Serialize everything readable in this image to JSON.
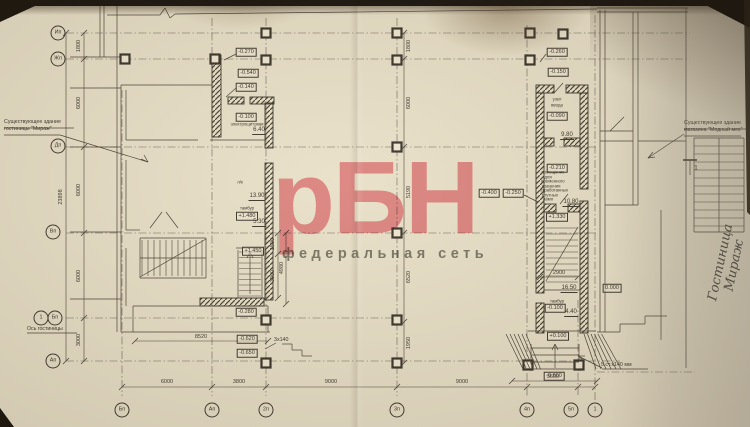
{
  "watermark": {
    "text": "рБН",
    "subtext": "федеральная сеть",
    "color": "#f195a2",
    "subcolor": "#85857e"
  },
  "notes": {
    "left_building": [
      "Существующее здание",
      "гостиницы \"Мираж\""
    ],
    "right_building": [
      "Существующее здание",
      "магазина \"Модный мех\""
    ],
    "hotel_axis": "Ось гостиницы",
    "handwriting": [
      "Гостиница",
      "Мираж"
    ],
    "section_label": "1",
    "steps_note": "5 ст.х140 мм",
    "steps_note_small": "3х140"
  },
  "axis_bubbles": [
    {
      "label": "Ип",
      "x": 58,
      "y": 33
    },
    {
      "label": "Жп",
      "x": 58,
      "y": 59
    },
    {
      "label": "Дп",
      "x": 58,
      "y": 146
    },
    {
      "label": "Вп",
      "x": 53,
      "y": 232
    },
    {
      "label": "1",
      "x": 41,
      "y": 318
    },
    {
      "label": "Бп",
      "x": 55,
      "y": 318
    },
    {
      "label": "Ап",
      "x": 53,
      "y": 361
    },
    {
      "label": "Бп",
      "x": 122,
      "y": 410
    },
    {
      "label": "Ап",
      "x": 212,
      "y": 410
    },
    {
      "label": "2п",
      "x": 266,
      "y": 410
    },
    {
      "label": "3п",
      "x": 397,
      "y": 410
    },
    {
      "label": "4п",
      "x": 527,
      "y": 410
    },
    {
      "label": "5п",
      "x": 571,
      "y": 410
    },
    {
      "label": "1",
      "x": 595,
      "y": 410
    }
  ],
  "elevations": [
    {
      "text": "-0.270",
      "x": 246,
      "y": 52
    },
    {
      "text": "-0.540",
      "x": 248,
      "y": 73
    },
    {
      "text": "-0.140",
      "x": 246,
      "y": 87
    },
    {
      "text": "-0.100",
      "x": 246,
      "y": 117
    },
    {
      "text": "+1.480",
      "x": 247,
      "y": 216
    },
    {
      "text": "+1.450",
      "x": 253,
      "y": 251
    },
    {
      "text": "-0.280",
      "x": 246,
      "y": 312
    },
    {
      "text": "-0.620",
      "x": 247,
      "y": 339
    },
    {
      "text": "-0.650",
      "x": 247,
      "y": 353
    },
    {
      "text": "-0.400",
      "x": 489,
      "y": 193
    },
    {
      "text": "-0.250",
      "x": 513,
      "y": 193
    },
    {
      "text": "-0.260",
      "x": 557,
      "y": 52
    },
    {
      "text": "-0.150",
      "x": 558,
      "y": 72
    },
    {
      "text": "-0.090",
      "x": 557,
      "y": 116
    },
    {
      "text": "-0.210",
      "x": 557,
      "y": 168
    },
    {
      "text": "+1.330",
      "x": 557,
      "y": 217
    },
    {
      "text": "-0.100",
      "x": 555,
      "y": 308
    },
    {
      "text": "+0.100",
      "x": 558,
      "y": 336
    },
    {
      "text": "-0.600",
      "x": 554,
      "y": 376
    },
    {
      "text": "0.000",
      "x": 612,
      "y": 288
    }
  ],
  "areas": [
    {
      "text": "6.40",
      "x": 259,
      "y": 131
    },
    {
      "text": "13.90",
      "x": 257,
      "y": 197
    },
    {
      "text": "5.30",
      "x": 259,
      "y": 223
    },
    {
      "text": "9.80",
      "x": 567,
      "y": 136
    },
    {
      "text": "10.80",
      "x": 571,
      "y": 203
    },
    {
      "text": "16.50",
      "x": 569,
      "y": 289
    },
    {
      "text": "4.40",
      "x": 571,
      "y": 313
    }
  ],
  "room_labels": [
    {
      "text": "электрощитовая",
      "x": 247,
      "y": 125
    },
    {
      "text": "л/к",
      "x": 240,
      "y": 183
    },
    {
      "text": "тамбур",
      "x": 247,
      "y": 209
    },
    {
      "text": "узел",
      "x": 557,
      "y": 100
    },
    {
      "text": "ввода",
      "x": 557,
      "y": 106
    },
    {
      "text": "помещение",
      "x": 553,
      "y": 173
    },
    {
      "text": "для",
      "x": 548,
      "y": 177.5
    },
    {
      "text": "временного",
      "x": 553,
      "y": 182
    },
    {
      "text": "хранения",
      "x": 551,
      "y": 186.5
    },
    {
      "text": "отработанных",
      "x": 554,
      "y": 191
    },
    {
      "text": "ртутных",
      "x": 550,
      "y": 195.5
    },
    {
      "text": "ламп",
      "x": 548,
      "y": 200
    },
    {
      "text": "тамбур",
      "x": 557,
      "y": 302
    }
  ],
  "dim_labels": [
    {
      "text": "1800",
      "x": 79,
      "y": 46,
      "rot": 1
    },
    {
      "text": "6000",
      "x": 79,
      "y": 103,
      "rot": 1
    },
    {
      "text": "6000",
      "x": 79,
      "y": 190,
      "rot": 1
    },
    {
      "text": "6000",
      "x": 79,
      "y": 276,
      "rot": 1
    },
    {
      "text": "3000",
      "x": 79,
      "y": 340,
      "rot": 1
    },
    {
      "text": "23898",
      "x": 61,
      "y": 197,
      "rot": 1
    },
    {
      "text": "1500",
      "x": 273,
      "y": 244,
      "rot": 1
    },
    {
      "text": "3000",
      "x": 273,
      "y": 276,
      "rot": 1
    },
    {
      "text": "4980",
      "x": 282,
      "y": 268,
      "rot": 1
    },
    {
      "text": "1800",
      "x": 409,
      "y": 46,
      "rot": 1
    },
    {
      "text": "6000",
      "x": 409,
      "y": 103,
      "rot": 1
    },
    {
      "text": "5190",
      "x": 409,
      "y": 192,
      "rot": 1
    },
    {
      "text": "6520",
      "x": 409,
      "y": 277,
      "rot": 1
    },
    {
      "text": "1950",
      "x": 409,
      "y": 343,
      "rot": 1
    },
    {
      "text": "6000",
      "x": 167,
      "y": 382
    },
    {
      "text": "3800",
      "x": 239,
      "y": 382
    },
    {
      "text": "9000",
      "x": 331,
      "y": 382
    },
    {
      "text": "9000",
      "x": 462,
      "y": 382
    },
    {
      "text": "3600",
      "x": 553,
      "y": 377
    },
    {
      "text": "8520",
      "x": 201,
      "y": 337
    },
    {
      "text": "2900",
      "x": 559,
      "y": 273
    }
  ]
}
